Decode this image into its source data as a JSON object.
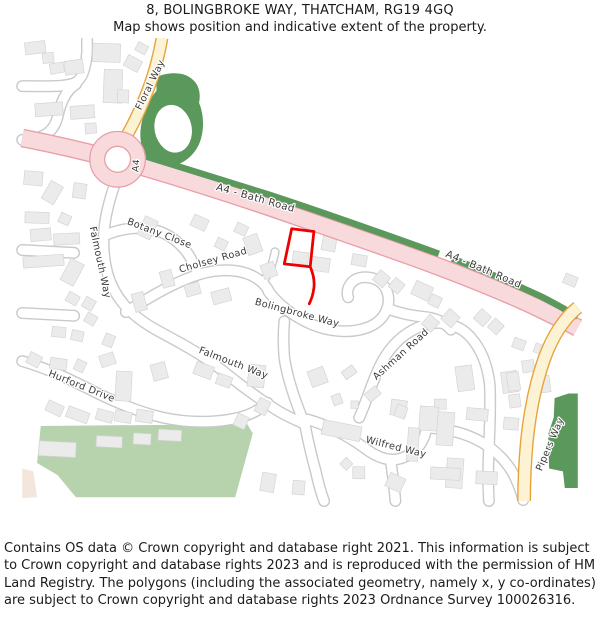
{
  "header": {
    "title": "8, BOLINGBROKE WAY, THATCHAM, RG19 4GQ",
    "subtitle": "Map shows position and indicative extent of the property."
  },
  "map": {
    "road_labels": [
      {
        "text": "Floral Way"
      },
      {
        "text": "A4"
      },
      {
        "text": "A4 - Bath Road"
      },
      {
        "text": "A4 - Bath Road"
      },
      {
        "text": "Botany Close"
      },
      {
        "text": "Cholsey Road"
      },
      {
        "text": "Falmouth Way"
      },
      {
        "text": "Bolingbroke Way"
      },
      {
        "text": "Falmouth Way"
      },
      {
        "text": "Hurford Drive"
      },
      {
        "text": "Ashman Road"
      },
      {
        "text": "Wilfred Way"
      },
      {
        "text": "Pipers Way"
      }
    ],
    "colors": {
      "property_outline": "#ee0000",
      "a_road_fill": "#f8dadd",
      "a_road_casing": "#e99fa8",
      "primary_road_fill": "#fcf2d4",
      "primary_road_casing": "#e7a33c",
      "minor_road_fill": "#ffffff",
      "minor_road_casing": "#c9c9c9",
      "woodland_green": "#5a985c",
      "park_green": "#b7d3ae",
      "building_fill": "#ebebeb"
    }
  },
  "footer": {
    "text": "Contains OS data © Crown copyright and database right 2021. This information is subject to Crown copyright and database rights 2023 and is reproduced with the permission of HM Land Registry. The polygons (including the associated geometry, namely x, y co-ordinates) are subject to Crown copyright and database rights 2023 Ordnance Survey 100026316."
  }
}
